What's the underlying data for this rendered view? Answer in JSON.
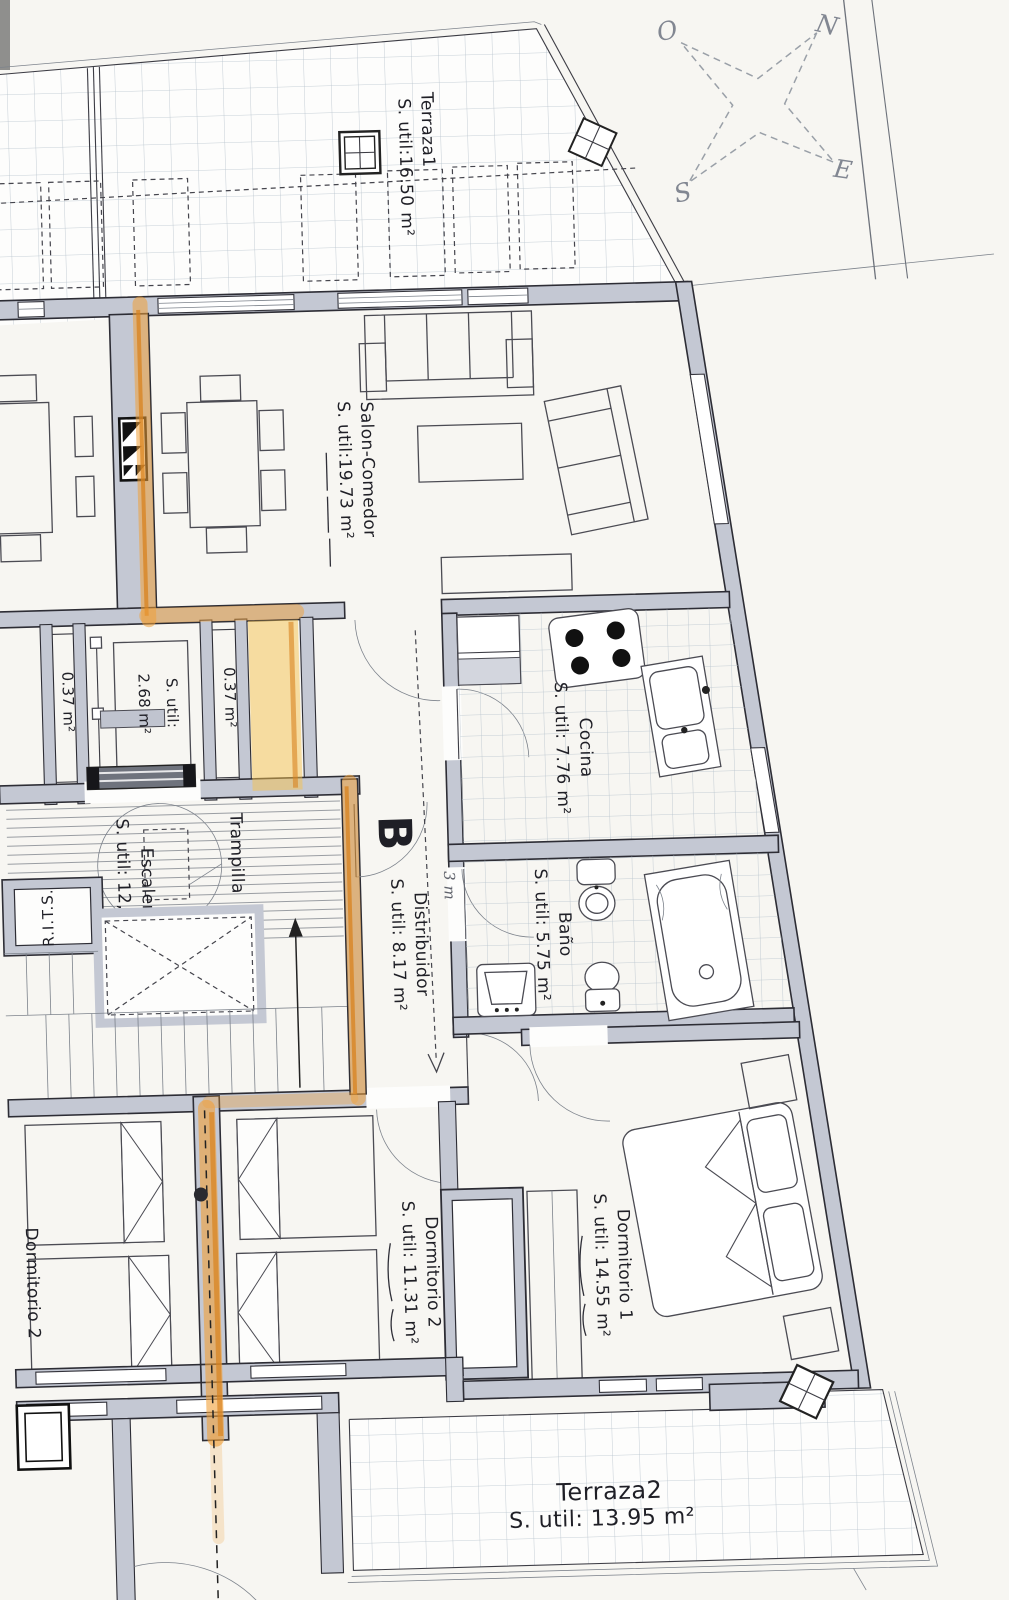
{
  "document": {
    "type": "apartment-floor-plan",
    "language": "es"
  },
  "plan": {
    "rooms": {
      "terraza1": {
        "name": "Terraza1",
        "area": "S. util:16.50 m²"
      },
      "salon": {
        "name": "Salon-Comedor",
        "area": "S. util:19.73 m²"
      },
      "cocina": {
        "name": "Cocina",
        "area": "S. util: 7.76 m²"
      },
      "bano": {
        "name": "Baño",
        "area": "S. util: 5.75 m²"
      },
      "distribuidor": {
        "name": "Distribuidor",
        "area": "S. util: 8.17 m²"
      },
      "escaleras": {
        "name": "Escaleras",
        "area": "S. util: 12,92 m²"
      },
      "dormitorio1": {
        "name": "Dormitorio 1",
        "area": "S. util: 14.55 m²"
      },
      "dormitorio2": {
        "name": "Dormitorio 2",
        "area": "S. util: 11.31 m²"
      },
      "neighbor_dormitorio2": {
        "name": "Dormitorio 2"
      },
      "terraza2": {
        "name": "Terraza2",
        "area": "S. util: 13.95 m²"
      },
      "vestibulo": {
        "area_line1": "S. util:",
        "area_line2": "2.68 m²"
      },
      "shaft_left": {
        "area": "0.37 m²"
      },
      "shaft_right": {
        "area": "0.37 m²"
      }
    },
    "labels": {
      "trampilla": "Trampilla",
      "rits": "R.I.T.S.",
      "section_letter": "B",
      "handwritten_note": "3 m"
    },
    "compass": {
      "north": "N",
      "south": "S",
      "east": "E",
      "west": "O"
    },
    "colors": {
      "wall": "#c4c8d3",
      "line": "#2d2d35",
      "tile": "#aebbc6",
      "highlighter": "#f1a13a",
      "highlighter_core": "#d9831f",
      "paper": "#f7f6f2"
    }
  }
}
